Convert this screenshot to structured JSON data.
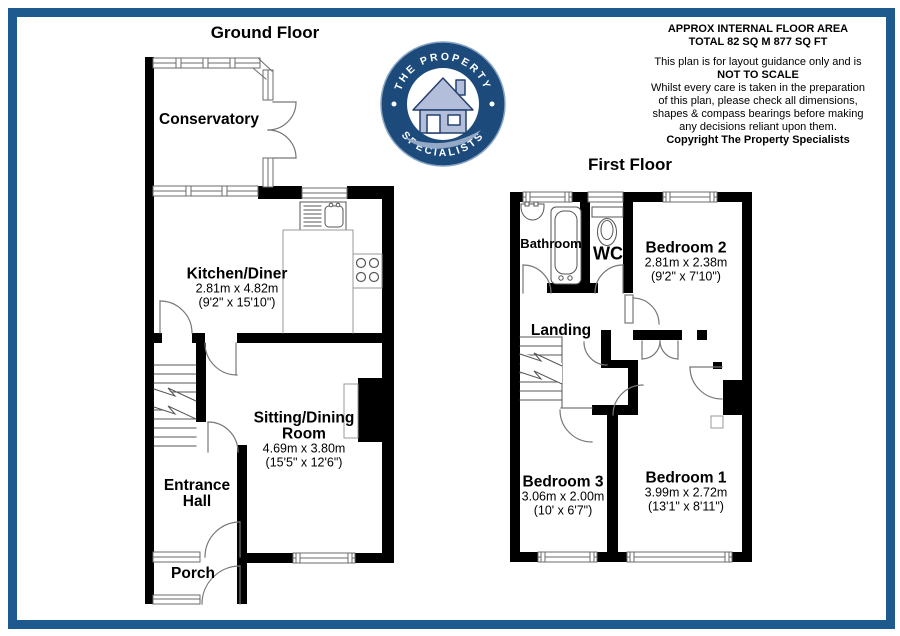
{
  "page": {
    "frame_color": "#1e5a8e",
    "background": "#ffffff"
  },
  "header": {
    "area_line1": "APPROX INTERNAL FLOOR AREA",
    "area_line2": "TOTAL 82 SQ M 877 SQ FT",
    "disclaimer_line1": "This plan is for layout guidance only and is",
    "disclaimer_line2": "NOT TO SCALE",
    "disclaimer_line3": "Whilst every care is taken in the preparation",
    "disclaimer_line4": "of this plan, please check all dimensions,",
    "disclaimer_line5": "shapes & compass bearings before making",
    "disclaimer_line6": "any decisions reliant upon them.",
    "copyright": "Copyright The Property Specialists"
  },
  "logo": {
    "top_text": "THE PROPERTY",
    "bottom_text": "SPECIALISTS",
    "ring_color": "#1b4a7b",
    "house_color": "#b3bfda",
    "swoosh_color": "#93a9c6"
  },
  "floors": {
    "ground": {
      "title": "Ground Floor",
      "rooms": {
        "conservatory": {
          "name": "Conservatory"
        },
        "kitchen": {
          "name": "Kitchen/Diner",
          "dims_m": "2.81m x 4.82m",
          "dims_ft": "(9'2\" x 15'10\")"
        },
        "sitting": {
          "name_line1": "Sitting/Dining",
          "name_line2": "Room",
          "dims_m": "4.69m x 3.80m",
          "dims_ft": "(15'5\" x 12'6\")"
        },
        "hall": {
          "name_line1": "Entrance",
          "name_line2": "Hall"
        },
        "porch": {
          "name": "Porch"
        }
      }
    },
    "first": {
      "title": "First Floor",
      "rooms": {
        "bathroom": {
          "name": "Bathroom"
        },
        "wc": {
          "name": "WC"
        },
        "bedroom2": {
          "name": "Bedroom 2",
          "dims_m": "2.81m x 2.38m",
          "dims_ft": "(9'2\" x 7'10\")"
        },
        "landing": {
          "name": "Landing"
        },
        "bedroom3": {
          "name": "Bedroom 3",
          "dims_m": "3.06m x 2.00m",
          "dims_ft": "(10' x 6'7\")"
        },
        "bedroom1": {
          "name": "Bedroom 1",
          "dims_m": "3.99m x 2.72m",
          "dims_ft": "(13'1\" x 8'11\")"
        }
      }
    }
  }
}
